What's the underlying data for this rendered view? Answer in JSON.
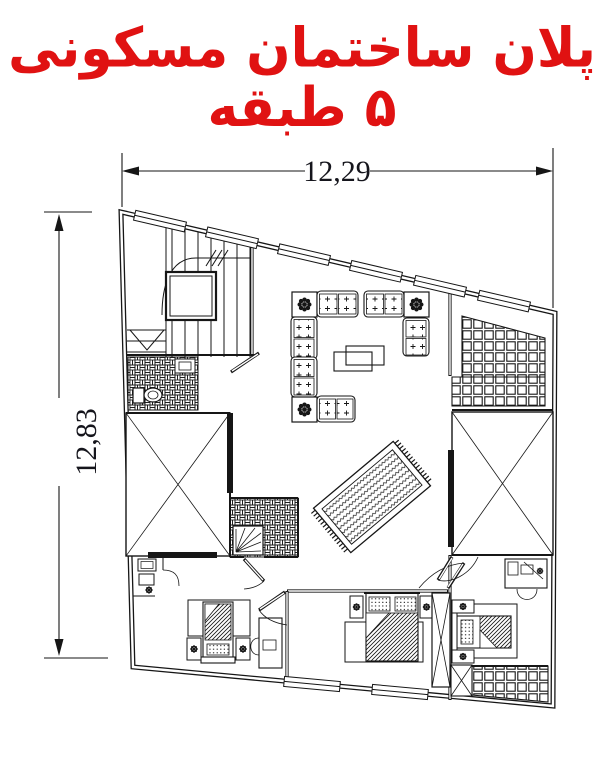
{
  "title": {
    "text": "پلان ساختمان مسکونی ۵ طبقه"
  },
  "colors": {
    "title_red": "#e01212",
    "ink": "#161616",
    "paper": "#ffffff"
  },
  "dimensions": {
    "top_width": "12,29",
    "left_height": "12,83"
  },
  "components": [
    "staircase",
    "elevator",
    "wc",
    "bathroom",
    "corner-shower",
    "living-room-sofas",
    "planter",
    "coffee-tables",
    "persian-rug",
    "terrace-tiles",
    "light-well",
    "double-bed",
    "single-bed",
    "nightstand",
    "lamp",
    "desk",
    "chair",
    "balcony-tiles",
    "closet",
    "door",
    "window",
    "toilet",
    "sink"
  ]
}
